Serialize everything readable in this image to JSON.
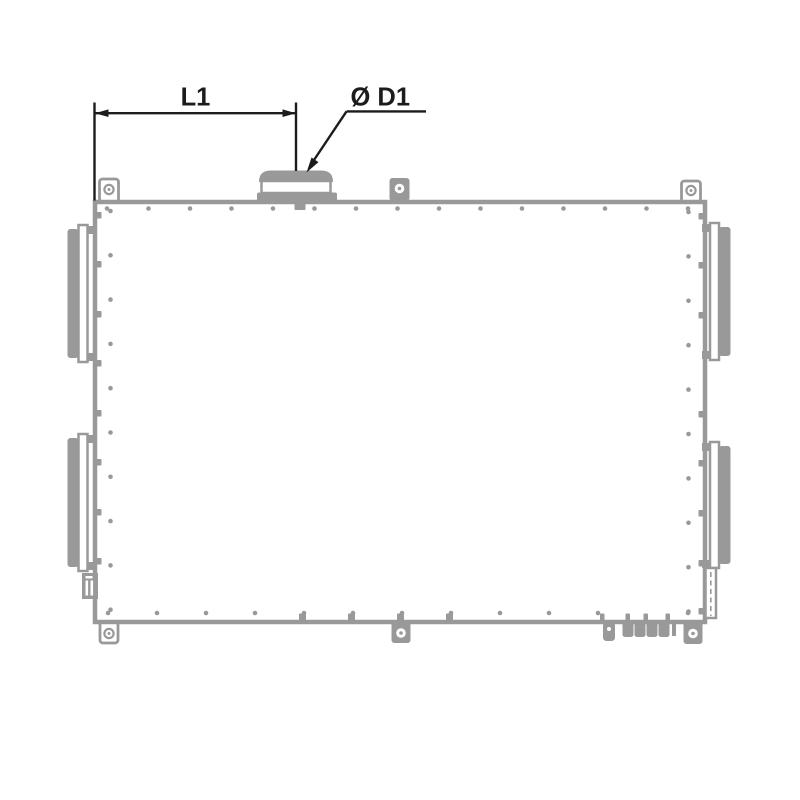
{
  "colors": {
    "outline_gray": "#999999",
    "dimension_black": "#1c1c1c",
    "background": "#ffffff"
  },
  "annotations": {
    "length_dimension_label": "L1",
    "diameter_callout_label": "Ø D1"
  }
}
